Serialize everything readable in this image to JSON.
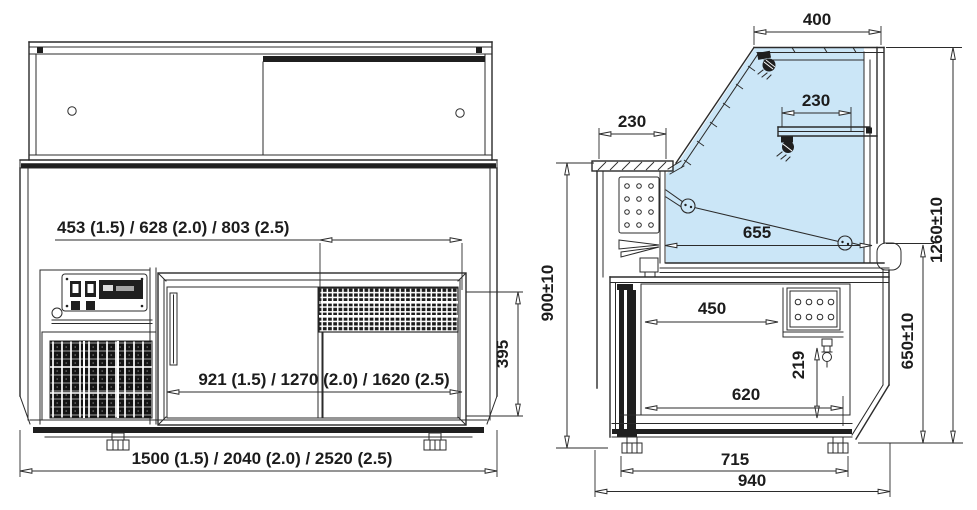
{
  "drawing_title": "refrigerated-serve-over-counter-dimension-drawing",
  "colors": {
    "line": "#2b2b2b",
    "glass_tint": "#cbe6f7",
    "paper": "#ffffff"
  },
  "labels": {
    "front": {
      "grille_width": "453 (1.5) / 628 (2.0) / 803 (2.5)",
      "door_width": "921 (1.5) / 1270 (2.0) / 1620 (2.5)",
      "overall_width": "1500 (1.5) / 2040 (2.0) / 2520 (2.5)",
      "door_height": "395"
    },
    "side": {
      "canopy_depth": "400",
      "shelf_depth": "230",
      "worktop_depth": "230",
      "display_deck_depth": "655",
      "worktop_height": "900±10",
      "base_inner_depth": "450",
      "drain_height": "219",
      "base_opening_depth": "620",
      "front_edge_height": "650±10",
      "overall_height": "1260±10",
      "feet_spacing": "715",
      "overall_depth": "940"
    }
  }
}
